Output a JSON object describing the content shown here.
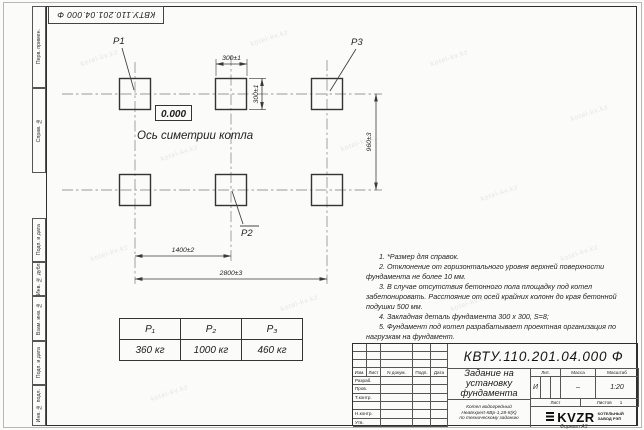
{
  "stamp": {
    "doc_number": "КВТУ.110.201.04.000 Ф"
  },
  "margin": {
    "top": [
      "Перв. примен.",
      "Справ. №"
    ],
    "bottom": [
      "Подп. и дата",
      "Инв. № дубл.",
      "Взам. инв. №",
      "Подп. и дата",
      "Инв. № подл."
    ]
  },
  "drawing": {
    "p1": "P1",
    "p2": "P2",
    "p3": "P3",
    "level": "0.000",
    "axis": "Ось симетрии котла",
    "dim_w": "300±1",
    "dim_h": "300±1",
    "dim_v": "960±3",
    "dim_mid": "1400±2",
    "dim_full": "2800±3"
  },
  "notes": [
    "1. *Размер для справок.",
    "2. Отклонение от горизонтального уровня верхней поверхности фундамента не более 10 мм.",
    "3. В случае отсутствия бетонного пола площадку под котел забетонировать. Расстояние от осей крайних колонн до края бетонной подушки 500 мм.",
    "4. Закладная деталь фундамента 300 x 300, S=8;",
    "5. Фундамент под котел разрабатывает проектная организация по нагрузкам на фундамент."
  ],
  "table": {
    "headers": [
      "P₁",
      "P₂",
      "P₃"
    ],
    "values": [
      "360 кг",
      "1000 кг",
      "460 кг"
    ]
  },
  "titleblock": {
    "doc_number": "КВТУ.110.201.04.000 Ф",
    "title_lines": [
      "Задание на",
      "установку",
      "фундамента"
    ],
    "subtitle_lines": [
      "Котел водогрейный",
      "Heatexpert-КВр-1,28-К(К)",
      "по техническому заданию"
    ],
    "cols": [
      "Изм.",
      "Лист",
      "N докум.",
      "Подп.",
      "Дата"
    ],
    "rows": [
      "Разраб.",
      "Пров.",
      "Т.контр.",
      "",
      "Н.контр.",
      "Утв."
    ],
    "lit": {
      "header": "Лит.",
      "value": "И"
    },
    "mass": {
      "header": "Масса",
      "value": "–"
    },
    "scale": {
      "header": "Масштаб",
      "value": "1:20"
    },
    "sheet": {
      "label": "Лист",
      "sheets_label": "Листов",
      "sheets_value": "1"
    },
    "logo": {
      "text": "KVZR",
      "caption1": "КОТЕЛЬНЫЙ",
      "caption2": "ЗАВОД РЭП"
    },
    "format": "Формат А3"
  },
  "watermark": {
    "text": "kotel-kv.kz"
  }
}
